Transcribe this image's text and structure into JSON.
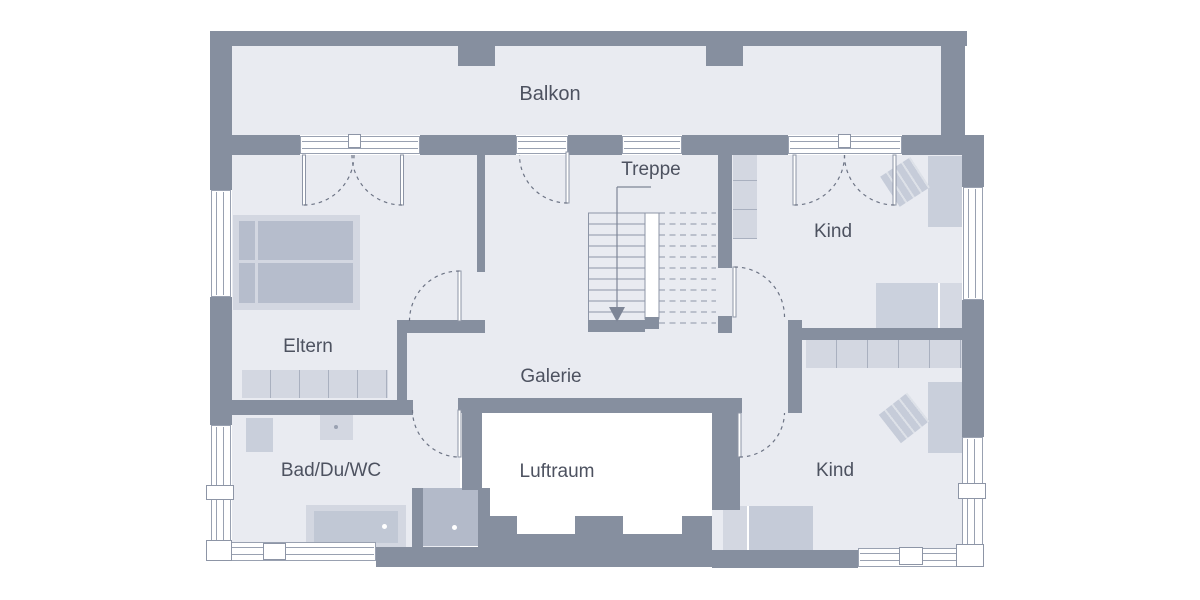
{
  "plan": {
    "title": "floor-plan",
    "rooms": [
      {
        "id": "balkon",
        "label": "Balkon"
      },
      {
        "id": "treppe",
        "label": "Treppe"
      },
      {
        "id": "kind-top",
        "label": "Kind"
      },
      {
        "id": "eltern",
        "label": "Eltern"
      },
      {
        "id": "galerie",
        "label": "Galerie"
      },
      {
        "id": "bad",
        "label": "Bad/Du/WC"
      },
      {
        "id": "luftraum",
        "label": "Luftraum"
      },
      {
        "id": "kind-bottom",
        "label": "Kind"
      }
    ],
    "colors": {
      "wall": "#868f9f",
      "floor": "#e9ebf1",
      "furniture": "#d3d7e1",
      "furniture_mid": "#c9cfdb",
      "bed_dark": "#b6bdcc",
      "shower": "#b3bac9",
      "tub_inner": "#c1c8d5",
      "window": "#ffffff",
      "frame": "#99a1b1",
      "stroke": "#8d95a6",
      "line": "#6d7485",
      "stair": "#8d95a6",
      "label": "#4d5260",
      "void": "#ffffff"
    }
  }
}
